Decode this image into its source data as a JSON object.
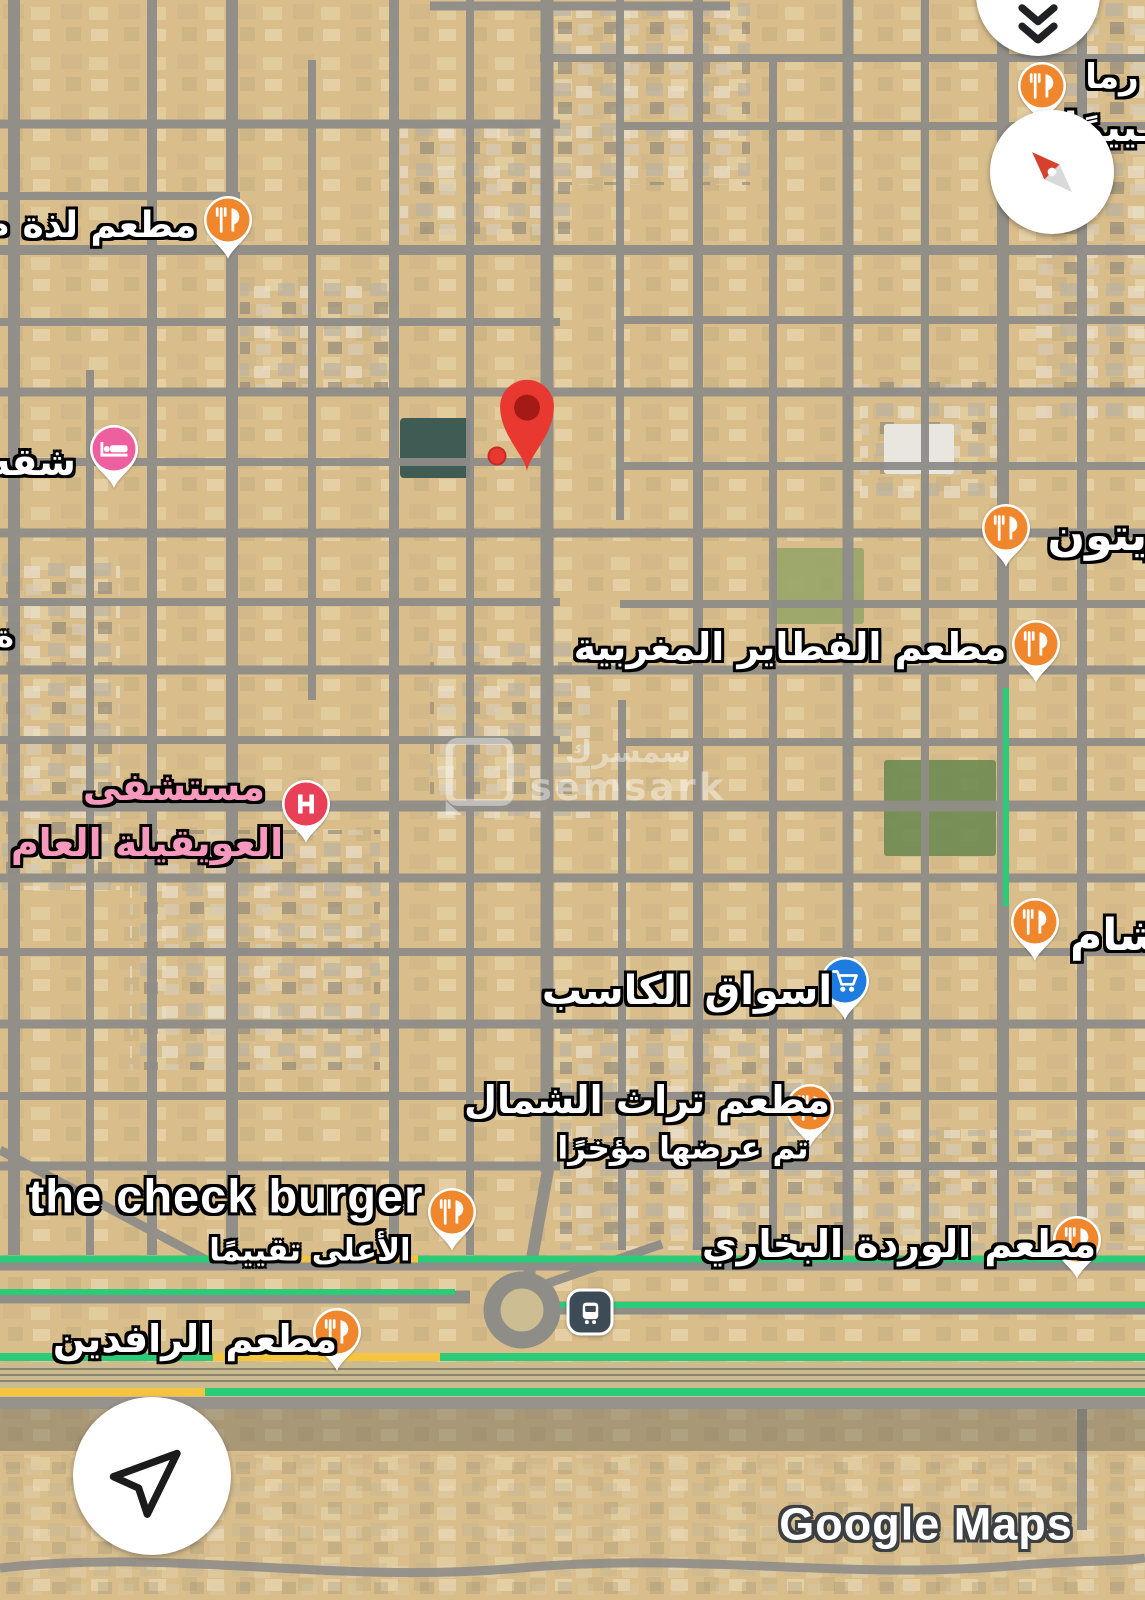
{
  "app": "google-maps-satellite-view",
  "pois": [
    {
      "id": "lathah",
      "type": "restaurant",
      "label": "مطعم لذة م"
    },
    {
      "id": "top-right-restaurant",
      "type": "restaurant",
      "label": ""
    },
    {
      "id": "shaqah",
      "type": "hotel",
      "label": "شقه"
    },
    {
      "id": "zaytoon",
      "type": "restaurant",
      "label": "زيتون"
    },
    {
      "id": "fatayer",
      "type": "restaurant",
      "label": "مطعم الفطاير المغربية"
    },
    {
      "id": "oweiqila-hospital",
      "type": "hospital",
      "label": "مستشفى",
      "label2": "العويقيلة العام"
    },
    {
      "id": "kasib-markets",
      "type": "supermarket",
      "label": "اسواق الكاسب"
    },
    {
      "id": "sham",
      "type": "restaurant",
      "label": "شام"
    },
    {
      "id": "turath-alshamal",
      "type": "restaurant",
      "label": "مطعم تراث الشمال",
      "sublabel": "تم عرضها مؤخرًا"
    },
    {
      "id": "the-check-burger",
      "type": "restaurant",
      "label": "the check burger",
      "sublabel": "الأعلى تقييمًا"
    },
    {
      "id": "wardah-bukhari",
      "type": "restaurant",
      "label": "مطعم الوردة البخاري"
    },
    {
      "id": "rafidain",
      "type": "restaurant",
      "label": "مطعم الرافدين"
    },
    {
      "id": "bus-station",
      "type": "bus-station",
      "label": ""
    }
  ],
  "edge_labels": [
    "رما",
    "ـييمًا",
    "ة"
  ],
  "watermarks": {
    "map_brand_arabic": "سمسرك",
    "map_brand_latin": "semsark",
    "google": "Google Maps"
  },
  "icons": {
    "collapse": "double-chevron-down-icon",
    "compass": "compass-needle-icon",
    "recenter": "navigation-arrow-icon",
    "restaurant": "fork-knife-pin-icon",
    "hotel": "bed-pin-icon",
    "hospital": "h-pin-icon",
    "supermarket": "shopping-cart-pin-icon",
    "bus": "bus-square-icon",
    "destination": "red-map-pin-icon"
  },
  "colors": {
    "restaurant_orange": "#F0872D",
    "hotel_pink": "#EE5FA0",
    "hospital_red": "#E94057",
    "hospital_text_pink": "#F799BD",
    "cart_blue": "#1E7BE0",
    "destination_red": "#E8382F",
    "destination_inner": "#A31B14",
    "traffic_green": "#2BCB77",
    "traffic_yellow": "#F5C542",
    "road_gray": "#8F8D88",
    "sand": "#D9BE8C",
    "bus_bg": "#3D4B56",
    "google_outline": "#3C4043"
  }
}
